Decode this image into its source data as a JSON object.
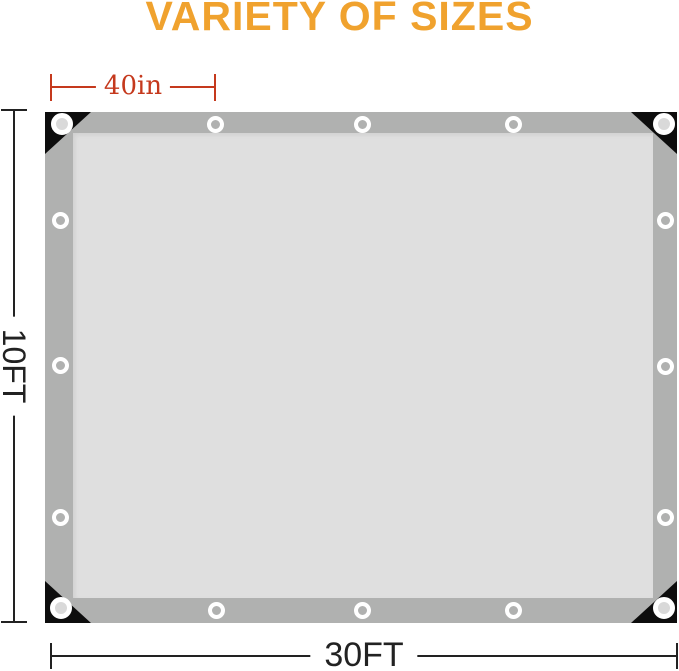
{
  "title": {
    "text": "VARIETY OF SIZES"
  },
  "colors": {
    "title_orange": "#F0A22E",
    "dimension_red": "#C5391D",
    "dimension_dark": "#222222",
    "tarp_band_gray": "#B0B1B0",
    "tarp_inner_gray": "#DFDFDF",
    "corner_black": "#0D0D0D",
    "grommet_white": "#FFFFFF",
    "grommet_hole_light": "#D9D9D9"
  },
  "measurements": {
    "grommet_spacing": {
      "label": "40in"
    },
    "height": {
      "label": "10FT"
    },
    "width": {
      "label": "30FT"
    }
  },
  "tarp": {
    "grommet_count": 16,
    "corner_reinforcement_count": 4
  }
}
